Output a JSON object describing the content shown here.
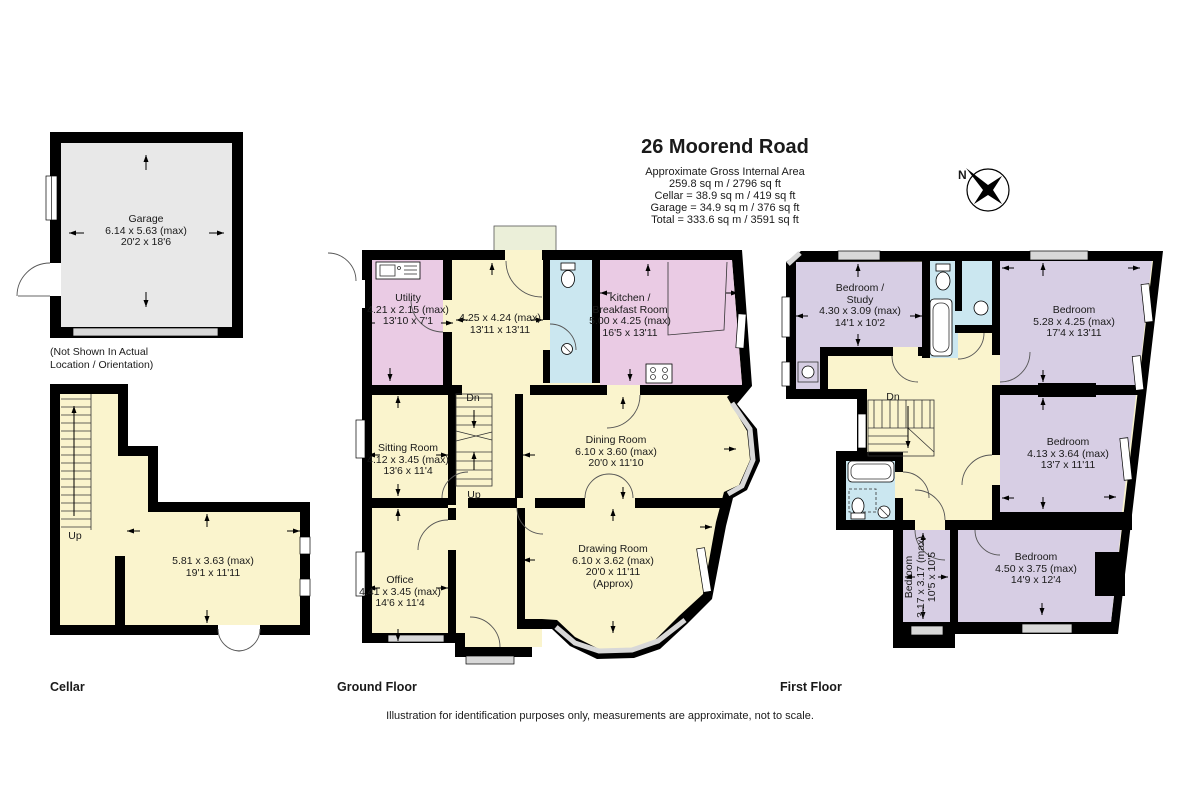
{
  "palette": {
    "wall": "#000000",
    "cream": "#FAF4CD",
    "pink": "#EACBE4",
    "purple": "#D7CEE4",
    "cyan": "#CBE7F0",
    "garage_gray": "#E8E8E8",
    "porch_green": "#EBEFD9",
    "window_gray": "#D8D8D8"
  },
  "header": {
    "title": "26 Moorend Road",
    "area_lines": [
      "Approximate Gross Internal Area",
      "259.8 sq m / 2796 sq ft",
      "Cellar = 38.9 sq m / 419 sq ft",
      "Garage = 34.9 sq m / 376 sq ft",
      "Total = 333.6 sq m / 3591 sq ft"
    ]
  },
  "compass": {
    "north": "N"
  },
  "stairs": {
    "up": "Up",
    "down": "Dn"
  },
  "floor_labels": {
    "cellar": "Cellar",
    "ground": "Ground Floor",
    "first": "First Floor"
  },
  "garage": {
    "name": "Garage",
    "metric": "6.14 x 5.63 (max)",
    "imperial": "20'2 x 18'6",
    "note_line1": "(Not Shown In Actual",
    "note_line2": "Location / Orientation)"
  },
  "cellar": {
    "room": {
      "metric": "5.81 x 3.63 (max)",
      "imperial": "19'1 x 11'11"
    }
  },
  "ground": {
    "utility": {
      "name": "Utility",
      "metric": "4.21 x 2.15 (max)",
      "imperial": "13'10 x 7'1"
    },
    "hall": {
      "metric": "4.25 x 4.24 (max)",
      "imperial": "13'11 x 13'11"
    },
    "kitchen": {
      "name1": "Kitchen /",
      "name2": "Breakfast Room",
      "metric": "5.00 x 4.25 (max)",
      "imperial": "16'5 x 13'11"
    },
    "sitting": {
      "name": "Sitting Room",
      "metric": "4.12 x 3.45 (max)",
      "imperial": "13'6 x 11'4"
    },
    "dining": {
      "name": "Dining Room",
      "metric": "6.10 x 3.60 (max)",
      "imperial": "20'0 x 11'10"
    },
    "office": {
      "name": "Office",
      "metric": "4.41 x 3.45 (max)",
      "imperial": "14'6 x 11'4"
    },
    "drawing": {
      "name": "Drawing Room",
      "metric": "6.10 x 3.62 (max)",
      "imperial": "20'0 x 11'11",
      "approx": "(Approx)"
    }
  },
  "first": {
    "study": {
      "name1": "Bedroom /",
      "name2": "Study",
      "metric": "4.30 x 3.09 (max)",
      "imperial": "14'1 x 10'2"
    },
    "bed_tr": {
      "name": "Bedroom",
      "metric": "5.28 x 4.25 (max)",
      "imperial": "17'4 x 13'11"
    },
    "bed_mr": {
      "name": "Bedroom",
      "metric": "4.13 x 3.64 (max)",
      "imperial": "13'7 x 11'11"
    },
    "bed_small": {
      "name": "Bedroom",
      "metric": "3.17 x 3.17 (max)",
      "imperial": "10'5 x 10'5"
    },
    "bed_br": {
      "name": "Bedroom",
      "metric": "4.50 x 3.75 (max)",
      "imperial": "14'9 x 12'4"
    }
  },
  "footer": "Illustration for identification purposes only, measurements are approximate, not to scale."
}
